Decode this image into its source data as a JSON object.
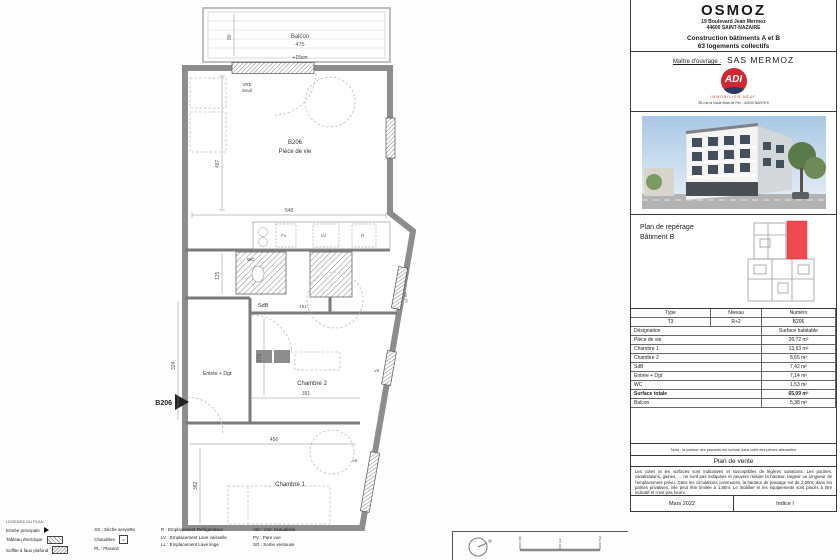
{
  "title_block": {
    "project": "OSMOZ",
    "address1": "19 Boulevard Jean Mermoz",
    "address2": "44600 SAINT-NAZAIRE",
    "program1": "Construction bâtiments A et B",
    "program2": "63 logements collectifs",
    "client_label": "Maître d'ouvrage :",
    "client_name": "SAS MERMOZ",
    "logo_text": "ADI",
    "logo_tagline": "IMMOBILIER NEUF",
    "logo_address": "2B rue la Noue Bras de Fer - 44200 NANTES",
    "reperage_line1": "Plan de repérage",
    "reperage_line2": "Bâtiment B"
  },
  "table": {
    "headers": [
      "Type",
      "Niveau",
      "Numéro"
    ],
    "unit": [
      "T3",
      "R+2",
      "B206"
    ],
    "designation_label": "Désignation",
    "surface_label": "Surface habitable",
    "rows": [
      [
        "Pièce de vie",
        "26,72 m²"
      ],
      [
        "Chambre 1",
        "13,63 m²"
      ],
      [
        "Chambre 2",
        "8,65 m²"
      ],
      [
        "SdB",
        "7,42 m²"
      ],
      [
        "Entrée + Dgt",
        "7,14 m²"
      ],
      [
        "WC",
        "1,53 m²"
      ]
    ],
    "total": [
      "Surface totale",
      "65,09 m²"
    ],
    "balcony": [
      "Balcon",
      "5,38 m²"
    ]
  },
  "footer": {
    "note": "Nota : la surface des placards est incluse dans celle des pièces attenantes",
    "sale_plan": "Plan de vente",
    "disclaimer": "Les cotes et les surfaces sont indicatives et susceptibles de légères variations. Les poutres, canalisations, gaines, ... ne sont pas indiquées et peuvent réduire la hauteur, largeur ou longueur de l'emplacement prévu. Dans les circulations communes, la hauteur de passage est de 2,00m; dans les parties privatives, elle peut être limitée à 1,80m. Le mobilier et les équipements sont placés à titre indicatif et n'est pas fourni.",
    "date": "Mars 2022",
    "index": "Indice I"
  },
  "legend": {
    "title": "LEGENDE DU PLAN",
    "col1": [
      "Entrée principale",
      "Tableau électrique",
      "Soffite à faux plafond"
    ],
    "col2": [
      "SS : Sèche serviette",
      "Chaudière",
      "PL : Placard"
    ],
    "col3": [
      "R : Emplacement Réfrigérateur",
      "LV : Emplacement Lave vaisselle",
      "LL : Emplacement Lave linge"
    ],
    "col4": [
      "VM : Vmc mutualisée",
      "PV : Pare vue",
      "SO : Sortie ventouse"
    ]
  },
  "plan": {
    "balcony_label": "Balcon",
    "balcony_dim": "475",
    "balcony_depth": "90",
    "threshold": "+15cm",
    "vre1": "VRE",
    "vre2": "Seuil",
    "unit_number": "B206",
    "living": "Pièce de vie",
    "dim_living_w": "548",
    "dim_living_h": "487",
    "dim_125": "125",
    "dim_191": "191",
    "wc": "WC",
    "sdb": "SdB",
    "entry": "Entrée + Dgt",
    "entry_arrow_label": "B206",
    "bedroom2": "Chambre 2",
    "dim_b2_w": "391",
    "dim_b2_h": "273",
    "dim_324": "324",
    "dim_456": "456",
    "bedroom1": "Chambre 1",
    "dim_b1_h": "382",
    "vr": "VR",
    "ab15": "AB.15",
    "fo": "Fo",
    "lv": "LV",
    "rf": "R"
  },
  "scale_bar": {
    "t0": "0",
    "t1": "1",
    "t2": "2"
  },
  "colors": {
    "wall": "#8d8d8d",
    "highlight_unit": "#f04a50",
    "logo_red": "#d22730",
    "logo_navy": "#283a5e"
  }
}
